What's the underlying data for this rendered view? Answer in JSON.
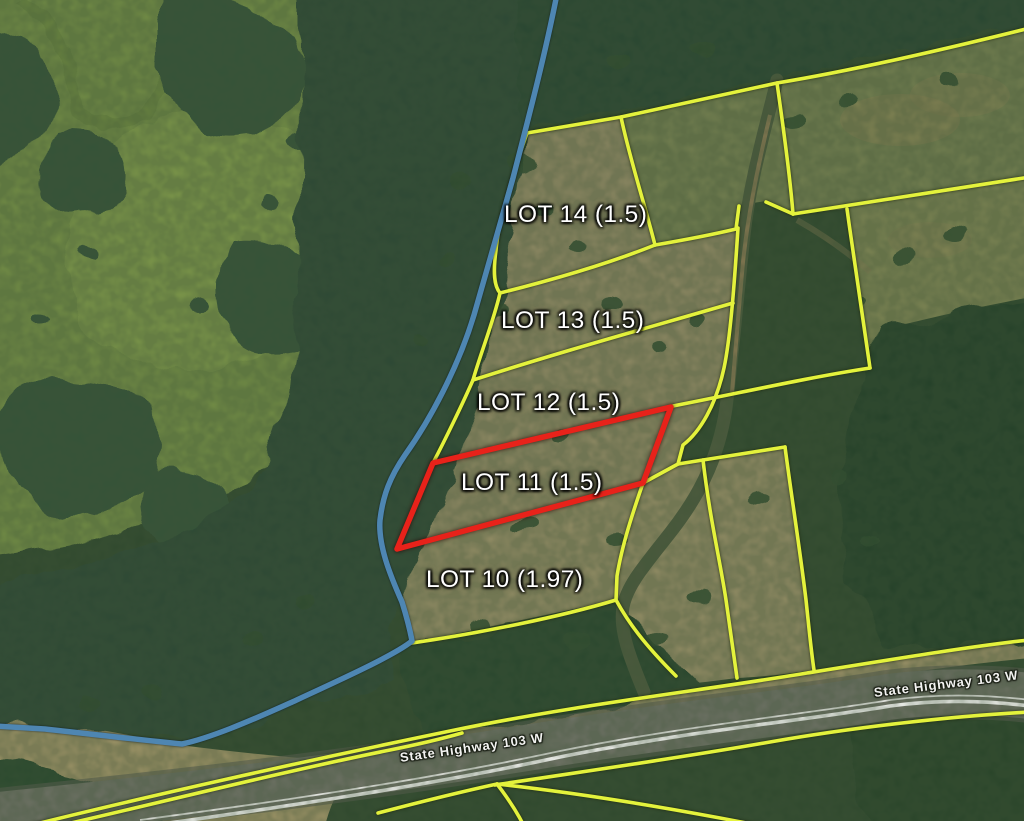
{
  "map": {
    "lots": [
      {
        "name": "LOT 14",
        "acres": "1.5",
        "label": "LOT 14 (1.5)",
        "featured": false
      },
      {
        "name": "LOT 13",
        "acres": "1.5",
        "label": "LOT 13 (1.5)",
        "featured": false
      },
      {
        "name": "LOT 12",
        "acres": "1.5",
        "label": "LOT 12 (1.5)",
        "featured": false
      },
      {
        "name": "LOT 11",
        "acres": "1.5",
        "label": "LOT 11 (1.5)",
        "featured": true
      },
      {
        "name": "LOT 10",
        "acres": "1.97",
        "label": "LOT 10 (1.97)",
        "featured": false
      }
    ],
    "highway": {
      "label": "State Highway 103 W"
    },
    "colors": {
      "lot_boundary": "#e4f23c",
      "featured_lot_boundary": "#e8221a",
      "water_boundary": "#4e86b2",
      "road_stripe": "#f8f8f6"
    }
  }
}
